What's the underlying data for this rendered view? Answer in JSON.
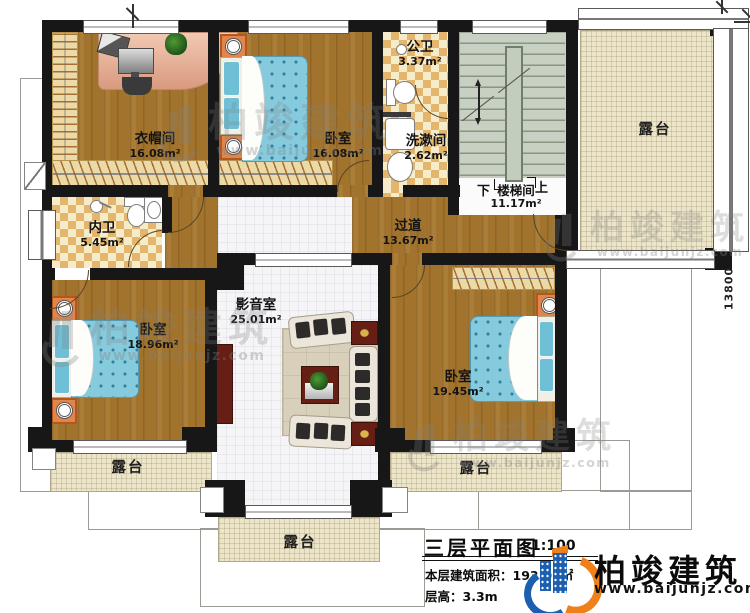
{
  "plan": {
    "rooms": [
      {
        "name": "衣帽间",
        "area": "16.08m²"
      },
      {
        "name": "卧室",
        "area": "16.08m²"
      },
      {
        "name": "公卫",
        "area": "3.37m²"
      },
      {
        "name": "洗漱间",
        "area": "2.62m²"
      },
      {
        "name": "楼梯间",
        "area": "11.17m²"
      },
      {
        "name": "内卫",
        "area": "5.45m²"
      },
      {
        "name": "过道",
        "area": "13.67m²"
      },
      {
        "name": "影音室",
        "area": "25.01m²"
      },
      {
        "name": "卧室",
        "area": "18.96m²"
      },
      {
        "name": "卧室",
        "area": "19.45m²"
      }
    ],
    "terraces": [
      {
        "label": "露台"
      },
      {
        "label": "露台"
      },
      {
        "label": "露台"
      },
      {
        "label": "露台"
      }
    ],
    "stair_down": "下",
    "stair_up": "上",
    "dim_right": "13800"
  },
  "titleblock": {
    "title": "三层平面图",
    "scale": "1:100",
    "area_line": "本层建筑面积：193.05㎡",
    "floor_height": "层高：3.3m"
  },
  "brand": {
    "name": "柏竣建筑",
    "url": "www.baijunjz.com"
  },
  "watermark": {
    "name": "柏竣建筑",
    "url": "www.baijunjz.com"
  },
  "colors": {
    "wall": "#171717",
    "wood_floor": "#a1732c",
    "bathroom_tile": "#e4b56c",
    "terrace": "#ece5ca",
    "stair": "#c7d0c2",
    "bed": "#86cadd",
    "brand_blue": "#1b5fae",
    "brand_orange": "#f08019"
  }
}
